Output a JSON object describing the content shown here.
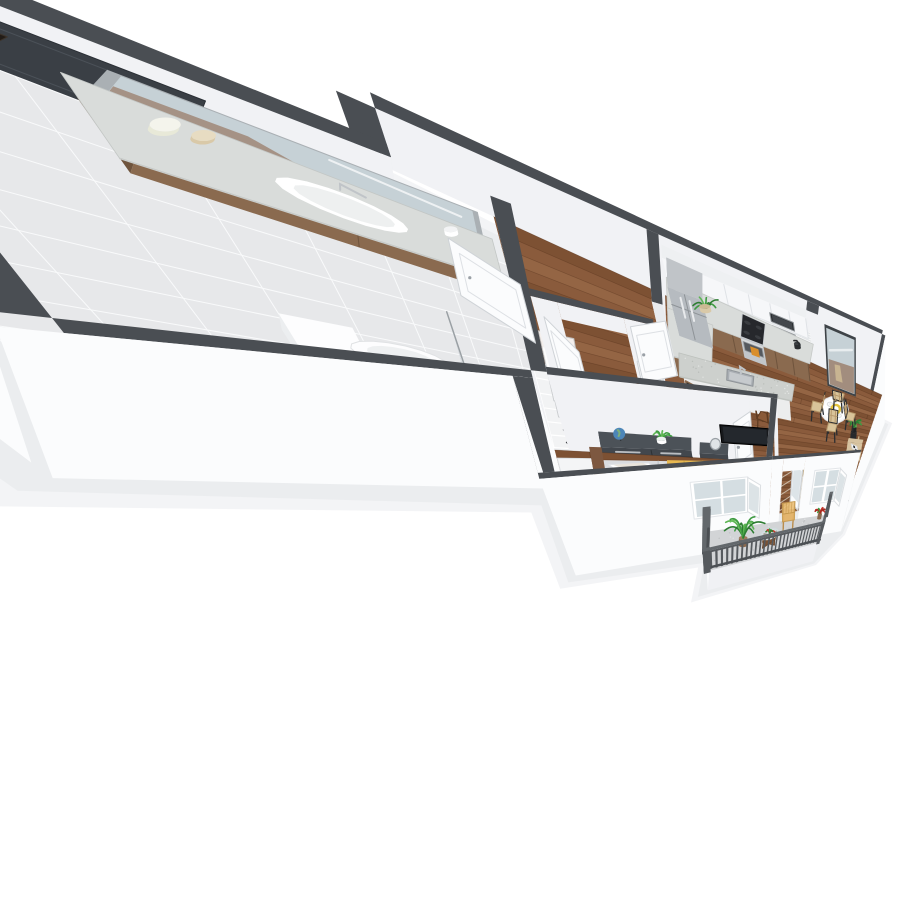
{
  "scene": {
    "kind": "isometric-3d-floor-plan",
    "subject": "one-bedroom apartment with balcony",
    "background": "#ffffff"
  },
  "colors": {
    "wallTop": "#4a4e53",
    "wallFace": "#f1f2f5",
    "wallFaceShade": "#e9ebee",
    "wallOuter": "#fbfcfd",
    "wallOuterShade": "#f0f1f4",
    "shadow": "#e9ebee",
    "wood": "#8a5b3d",
    "woodDark": "#73482c",
    "woodLight": "#9d6e4b",
    "woodSeam": "rgba(62,34,16,0.28)",
    "bathTile": "#e7e8ea",
    "closetTile": "#f2f3f4",
    "concrete": "#d2d4d6",
    "water": "#8ed9d3",
    "counter": "#d9dcda",
    "counterSpeckle": "#cdd0cd",
    "cabinetWood": "#8a6a4f",
    "cabinetWoodDark": "#6f543d",
    "cabinetWhite": "#f3f4f6",
    "steel": "#b6bbc0",
    "steelDark": "#a6abb0",
    "appliance": "#2a2d31",
    "sofa": "#d7c3a0",
    "sofaDark": "#c8b48e",
    "rugLiving": "#e6e0d5",
    "rugLattice": "#d8cfc0",
    "rugBedroom": "#dad7d2",
    "throw": "#e9ba52",
    "throwDark": "#d3a43f",
    "redPillow": "#c32330",
    "redPillowDark": "#a81a26",
    "dresser": "#42474d",
    "dresserSide": "#383d43",
    "dresserTop": "#4c5258",
    "doorWhite": "#fbfcfd",
    "doorDark": "#3a3f45",
    "railing": "#565a5e",
    "railingLight": "#63686c",
    "mirrorGlass": "#c6d1d6",
    "mirrorFrame": "#3e4347",
    "artTeal": "#2a7f97",
    "artBlue": "#1f5f8a",
    "artYellow": "#e2c23d",
    "artNavy": "#16425f",
    "artLight": "#79c7d4",
    "plantGreen": "#3f9b42",
    "plantGreenDark": "#2e7d32",
    "plantGreenLight": "#5cb552",
    "chairWeave": "#d9c49a",
    "chairWeaveDark": "#b89b6e",
    "wireChair": "#e3b164",
    "barChairWood": "#8a5a38",
    "bedding": "#ced1d4",
    "beddingTop": "#dadcdf",
    "headboard": "#6b4a33",
    "marble": "#d8d5d0",
    "marbleVein": "#b9b4ad",
    "glassLight": "#d3dce0",
    "chrome": "#c0c4c8"
  },
  "rooms": [
    {
      "id": "kitchen",
      "label": "Kitchen"
    },
    {
      "id": "dining-area",
      "label": "Dining Area"
    },
    {
      "id": "living-room",
      "label": "Living Room"
    },
    {
      "id": "bathroom",
      "label": "Bathroom"
    },
    {
      "id": "closet",
      "label": "Walk-in Closet"
    },
    {
      "id": "hallway",
      "label": "Hallway"
    },
    {
      "id": "bedroom",
      "label": "Bedroom"
    },
    {
      "id": "balcony",
      "label": "Balcony"
    }
  ],
  "furniture": {
    "kitchen": [
      "refrigerator",
      "upper-cabinets",
      "base-cabinets",
      "range-stove",
      "microwave",
      "peninsula-sink-counter",
      "bar-chairs",
      "potted-plant",
      "kettle"
    ],
    "dining-area": [
      "round-pedestal-table",
      "woven-chairs",
      "leaning-floor-mirror",
      "plant-stand"
    ],
    "living-room": [
      "beige-sofa",
      "cow-print-pillow",
      "abstract-wall-art",
      "white-coffee-table",
      "wood-side-table",
      "arc-floor-lamp",
      "knit-pouf",
      "red-pillows",
      "area-rug",
      "wall-tv",
      "casement-window"
    ],
    "bathroom": [
      "vanity-sink",
      "vanity-mirror",
      "toilet",
      "soaking-tub",
      "marble-shower",
      "shower-curtain",
      "wall-art"
    ],
    "closet": [
      "wire-shelving",
      "hanging-clothes"
    ],
    "bedroom": [
      "bed-yellow-throw",
      "dark-dresser",
      "nightstand",
      "globe",
      "desk",
      "desk-chair",
      "window"
    ],
    "balcony": [
      "slat-railing",
      "wire-lounge-chair",
      "glass-patio-table",
      "palm-plant",
      "flower-pot",
      "french-door"
    ]
  }
}
